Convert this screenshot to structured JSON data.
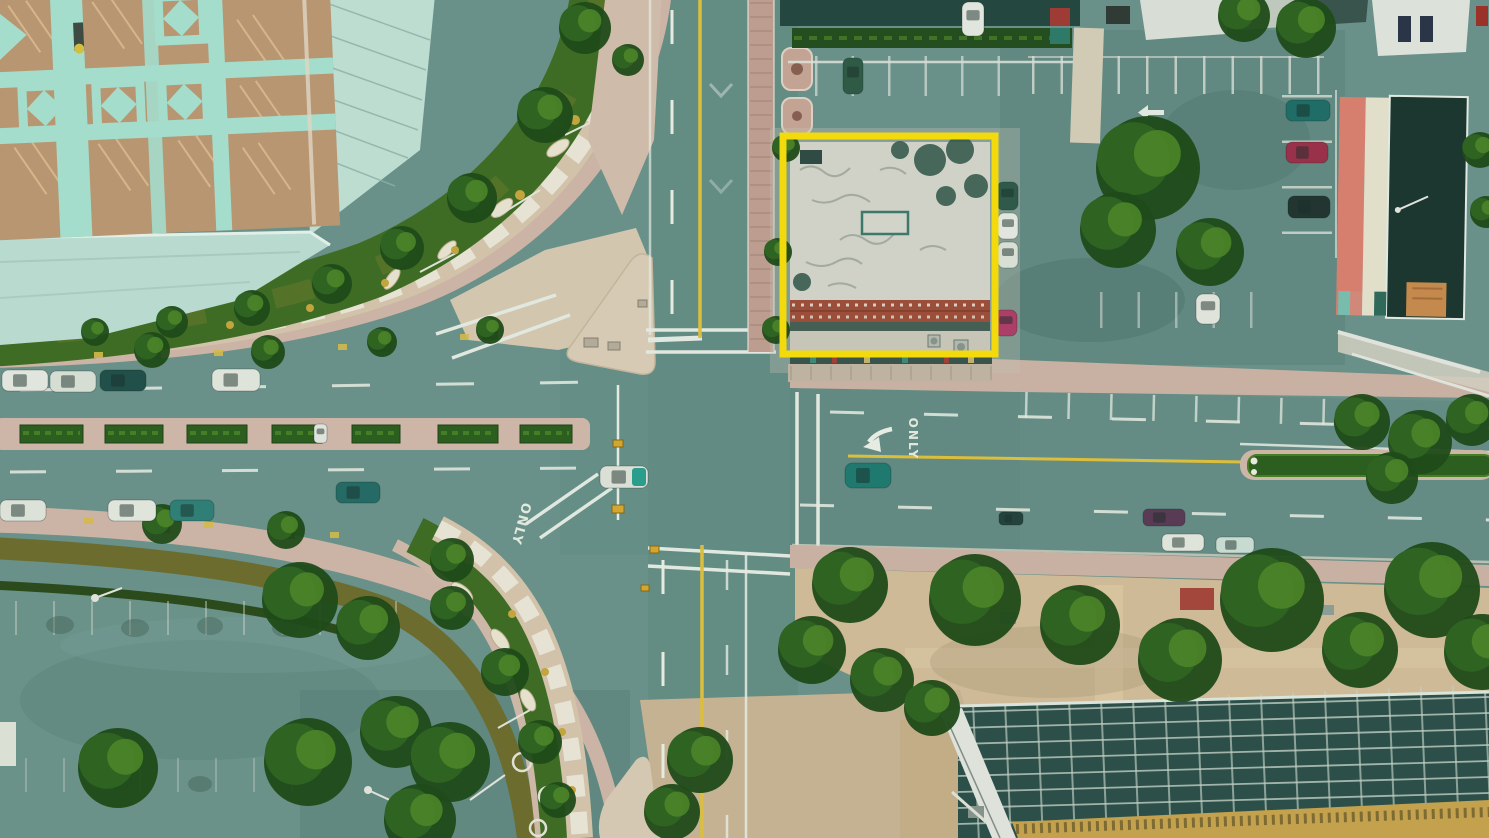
{
  "scene": {
    "description": "Top-down aerial drone photograph of a four-way city intersection; the flat-roofed commercial building on the north-east corner is outlined with a yellow highlight rectangle",
    "highlight": {
      "label": "highlighted-building",
      "color": "#F2DA0C"
    },
    "road_markings": [
      {
        "location": "south-leg-turn-lane",
        "text": "ONLY"
      },
      {
        "location": "east-road-left-turn-lane",
        "text": "ONLY"
      }
    ],
    "landmarks": [
      "rooftop parking deck with mint diamond pattern",
      "curved colonnade boulevard",
      "median hedgerows",
      "surface parking lots with parked cars",
      "salmon and cream striped building",
      "dark panelled warehouse roof with skylight grid",
      "street trees and garden bands"
    ],
    "palette": {
      "asphalt": "#6C938B",
      "sidewalk": "#D2B8A8",
      "island": "#DCCDB6",
      "tree_dark": "#1F4A16",
      "tree_light": "#4C8626",
      "hedge": "#2C5E1E",
      "deck_tan": "#BE9873",
      "mint": "#A9E2D0",
      "mint_roof": "#BFE0D4",
      "brick": "#A04F3A",
      "salmon": "#DE8070",
      "cream": "#E9E3CF",
      "dark_roof": "#1C352E",
      "panel_roof": "#2C4F48",
      "mustard": "#C9A44C",
      "lane_white": "#EDF1E7",
      "lane_yellow": "#E3C23C"
    }
  }
}
